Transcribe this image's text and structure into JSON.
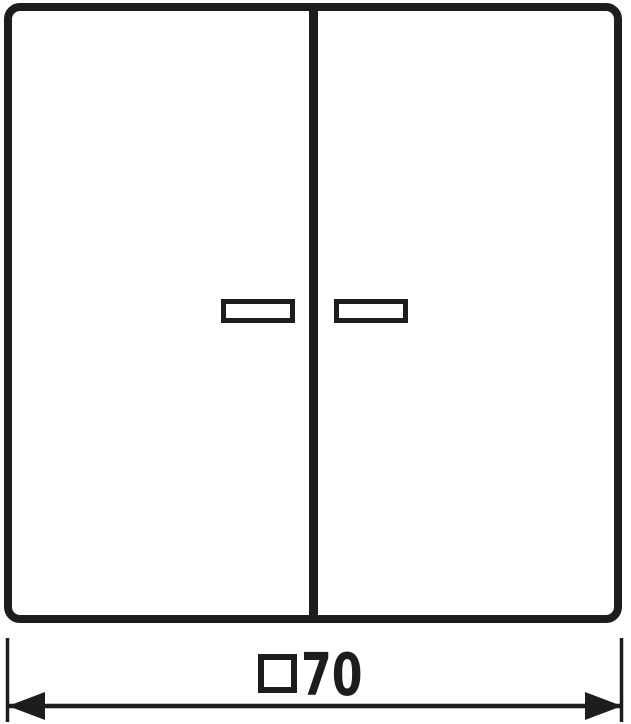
{
  "drawing": {
    "background_color": "#ffffff",
    "stroke_color": "#1d1d1b",
    "dimension_annotation": {
      "square_symbol_icon": "square-outline",
      "value": "70"
    }
  }
}
